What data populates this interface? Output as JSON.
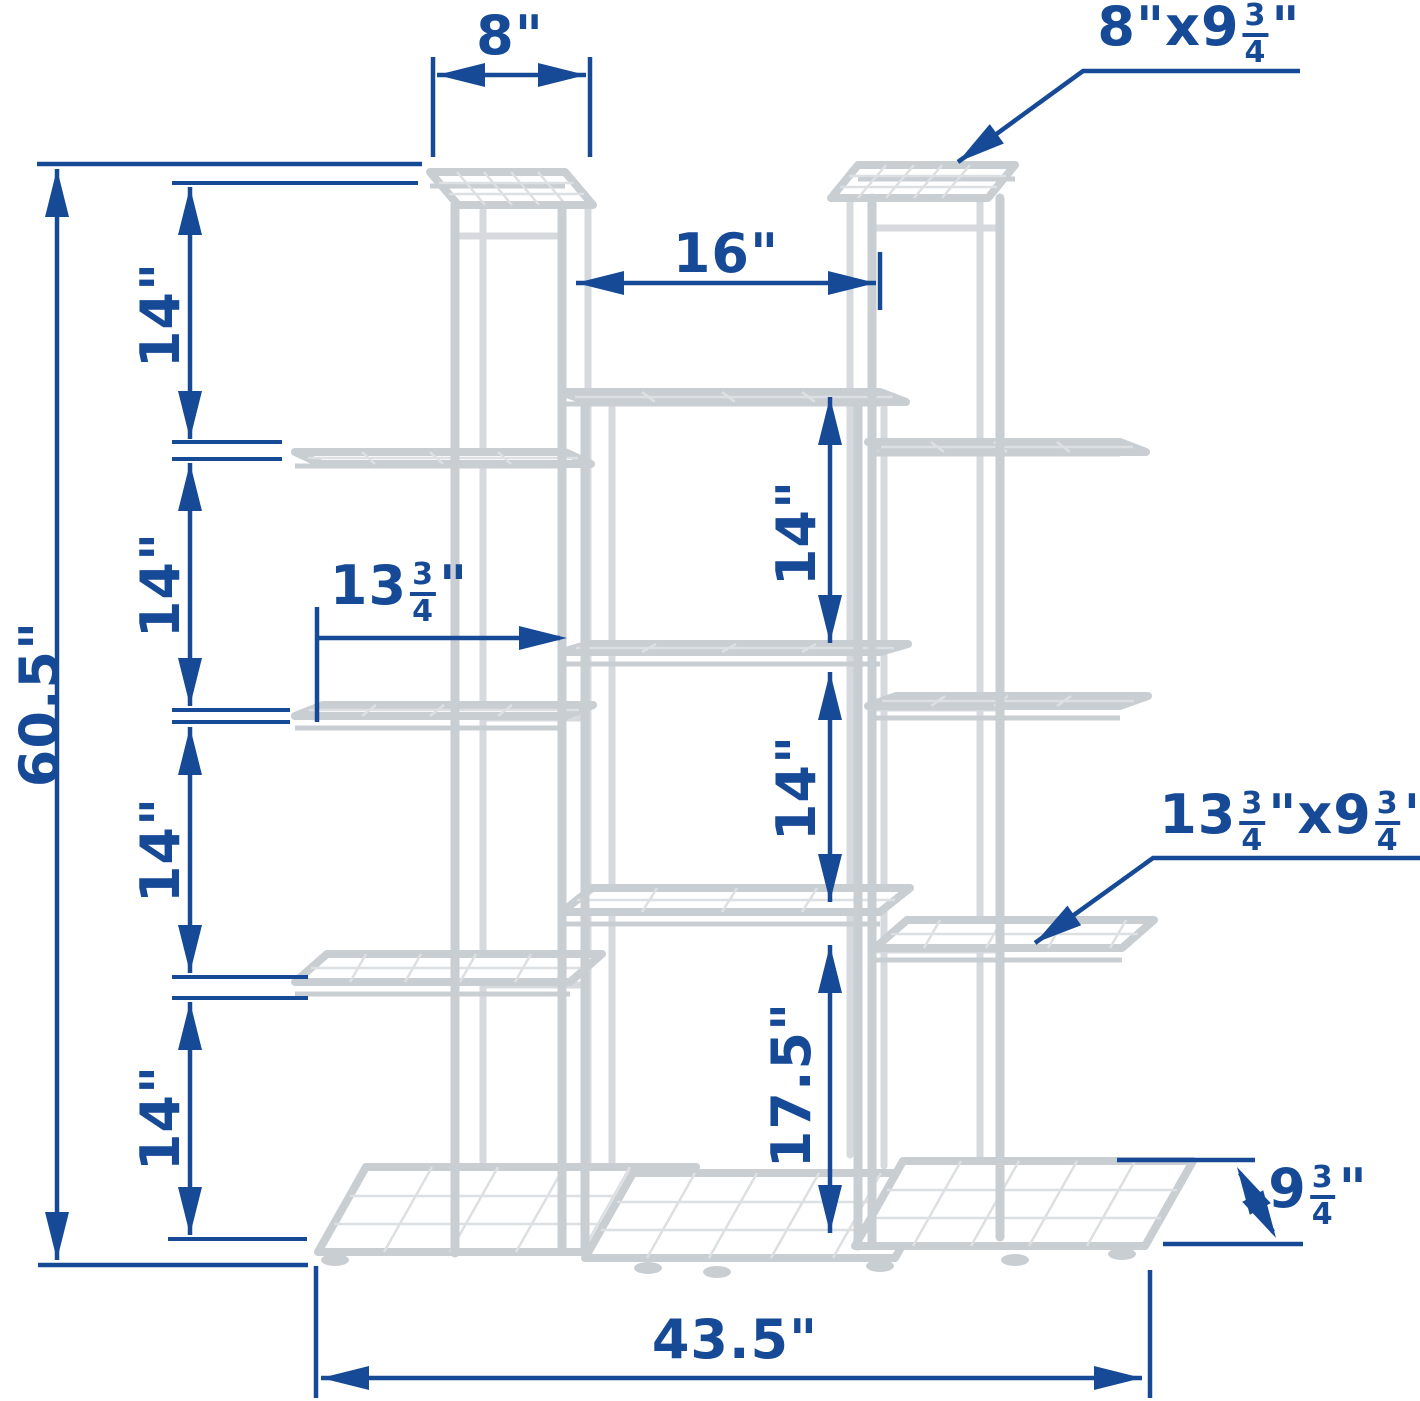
{
  "colors": {
    "dimension_blue": "#174a96",
    "structure_gray": "#c9ced3"
  },
  "labels": {
    "top_width": "8\"",
    "top_shelf_size": {
      "p1": "8\"x9",
      "n1": "3",
      "d1": "4",
      "s": "\""
    },
    "center_width": "16\"",
    "mid_shelf_width": {
      "p1": "13",
      "n1": "3",
      "d1": "4",
      "s": "\""
    },
    "side_shelf_size": {
      "p1": "13",
      "n1": "3",
      "d1": "4",
      "m": "\"x9",
      "n2": "3",
      "d2": "4",
      "s": "\""
    },
    "shelf_depth": {
      "p1": "9",
      "n1": "3",
      "d1": "4",
      "s": "\""
    },
    "total_height": "60.5\"",
    "total_width": "43.5\"",
    "left_spacing": [
      "14\"",
      "14\"",
      "14\"",
      "14\""
    ],
    "center_spacing_top": "14\"",
    "center_spacing_mid": "14\"",
    "bottom_spacing": "17.5\""
  }
}
